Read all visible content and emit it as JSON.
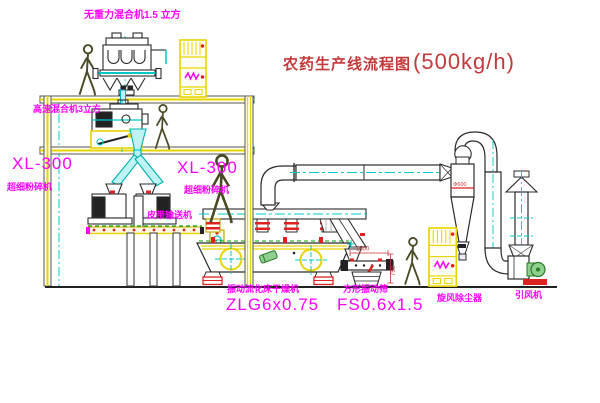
{
  "title": {
    "text": "农药生产线流程图",
    "capacity": "(500kg/h)"
  },
  "labels": {
    "gravity_mixer": "无重力混合机1.5 立方",
    "high_speed_mixer": "高速混合机3立方",
    "pulverizer_left_model": "XL-300",
    "pulverizer_left_name": "超细粉碎机",
    "pulverizer_mid_model": "XL-300",
    "pulverizer_mid_name": "超细粉碎机",
    "belt_conveyor": "皮带输送机",
    "dryer_name": "振动流化床干燥机",
    "dryer_model": "ZLG6x0.75",
    "screen_name": "方形振动筛",
    "screen_model": "FS0.6x1.5",
    "cyclone": "旋风除尘器",
    "fan": "引风机"
  },
  "dimensions": {
    "screen_length": "1500",
    "screen_height": "750",
    "cyclone_diameter": "Φ600"
  },
  "colors": {
    "label_magenta": "#ff00ff",
    "title_red": "#c43a3a",
    "cad_yellow": "#e8d400",
    "pipe_cyan": "#00c8c8",
    "machine_dark": "#2b2b2b",
    "detail_red": "#dd2222",
    "motor_green": "#2a7a2a"
  }
}
